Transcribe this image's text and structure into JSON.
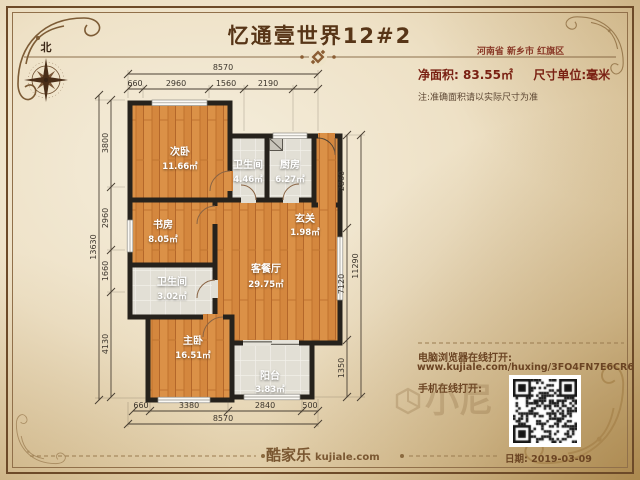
{
  "header": {
    "title": "忆通壹世界12#2",
    "region": "河南省 新乡市 红旗区",
    "net_area_label": "净面积:",
    "net_area_value": "83.55㎡",
    "unit_label": "尺寸单位:毫米",
    "note": "注:准确面积请以实际尺寸为准"
  },
  "compass": {
    "north_label": "北"
  },
  "plan": {
    "rooms": [
      {
        "name": "次卧",
        "area": "11.66㎡",
        "floor": "wood"
      },
      {
        "name": "卫生间",
        "area": "4.46㎡",
        "floor": "tile"
      },
      {
        "name": "厨房",
        "area": "6.27㎡",
        "floor": "tile"
      },
      {
        "name": "书房",
        "area": "8.05㎡",
        "floor": "wood"
      },
      {
        "name": "玄关",
        "area": "1.98㎡",
        "floor": "wood"
      },
      {
        "name": "客餐厅",
        "area": "29.75㎡",
        "floor": "wood"
      },
      {
        "name": "卫生间",
        "area": "3.02㎡",
        "floor": "tile"
      },
      {
        "name": "主卧",
        "area": "16.51㎡",
        "floor": "wood"
      },
      {
        "name": "阳台",
        "area": "3.83㎡",
        "floor": "tile"
      }
    ],
    "dims": {
      "top_overall": "8570",
      "top_segments": [
        "660",
        "2960",
        "1560",
        "2190"
      ],
      "left_overall": "13630",
      "left_segments": [
        "3800",
        "2960",
        "1660",
        "4130"
      ],
      "right_overall": "11290",
      "right_segments": [
        "2860",
        "7120",
        "1350"
      ],
      "bottom_overall": "8570",
      "bottom_segments": [
        "660",
        "3380",
        "2840",
        "500"
      ]
    }
  },
  "share": {
    "desktop_label": "电脑浏览器在线打开:",
    "url": "www.kujiale.com/huxing/3FO4FN7E6CR6",
    "mobile_label": "手机在线打开:"
  },
  "footer": {
    "logo_text": "酷家乐",
    "logo_domain": "kujiale.com",
    "date": "日期: 2019-03-09"
  },
  "watermark": "小尼",
  "colors": {
    "accent_brown": "#7a5731",
    "maroon": "#7a2113",
    "wall": "#26221c",
    "wood_floor": "#d4873e",
    "tile_floor": "#e2dfd5"
  }
}
